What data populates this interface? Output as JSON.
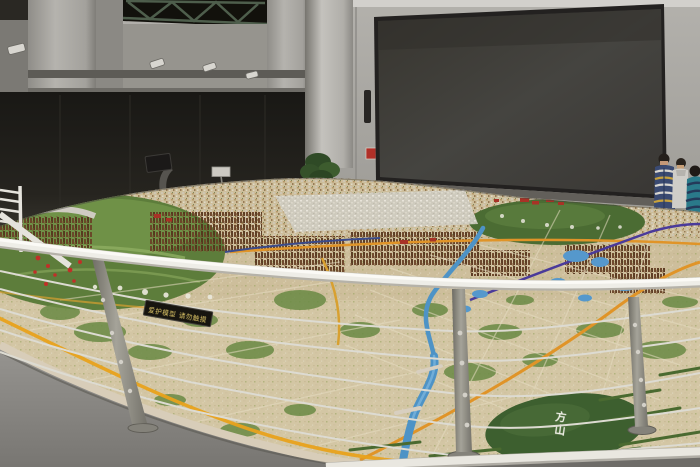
{
  "labels": {
    "plaque_text": "爱护模型 请勿触摸",
    "hill_label": "方山",
    "hill_label_top": "方",
    "hill_label_bottom": "山"
  },
  "palette": {
    "wall": "#a7a5a0",
    "wall_bright": "#bcbab5",
    "shadow_zone": "#211f1c",
    "truss_window": "#12110c",
    "truss_steel": "#4e5e4c",
    "screen_face": "#3e3c38",
    "screen_frame": "#232120",
    "floor": "#8a8884",
    "rail_white": "#edece6",
    "post_steel": "#8d8b83",
    "model_base": "#cdbe9b",
    "lawn_green": "#5d7d3b",
    "hill_green": "#4b6c33",
    "park_green": "#3d5f2f",
    "water_blue": "#4e93c6",
    "road_yellow": "#e8a21c",
    "road_orange": "#e09428",
    "metro_purple": "#4a3a9a",
    "towers_brown": "#5e3c22",
    "downtown_white": "#d6d2c6",
    "red_accent": "#a83226"
  },
  "people": [
    {
      "shirt": "navy-white striped cardigan"
    },
    {
      "shirt": "white shirt"
    },
    {
      "shirt": "teal striped shirt"
    }
  ]
}
